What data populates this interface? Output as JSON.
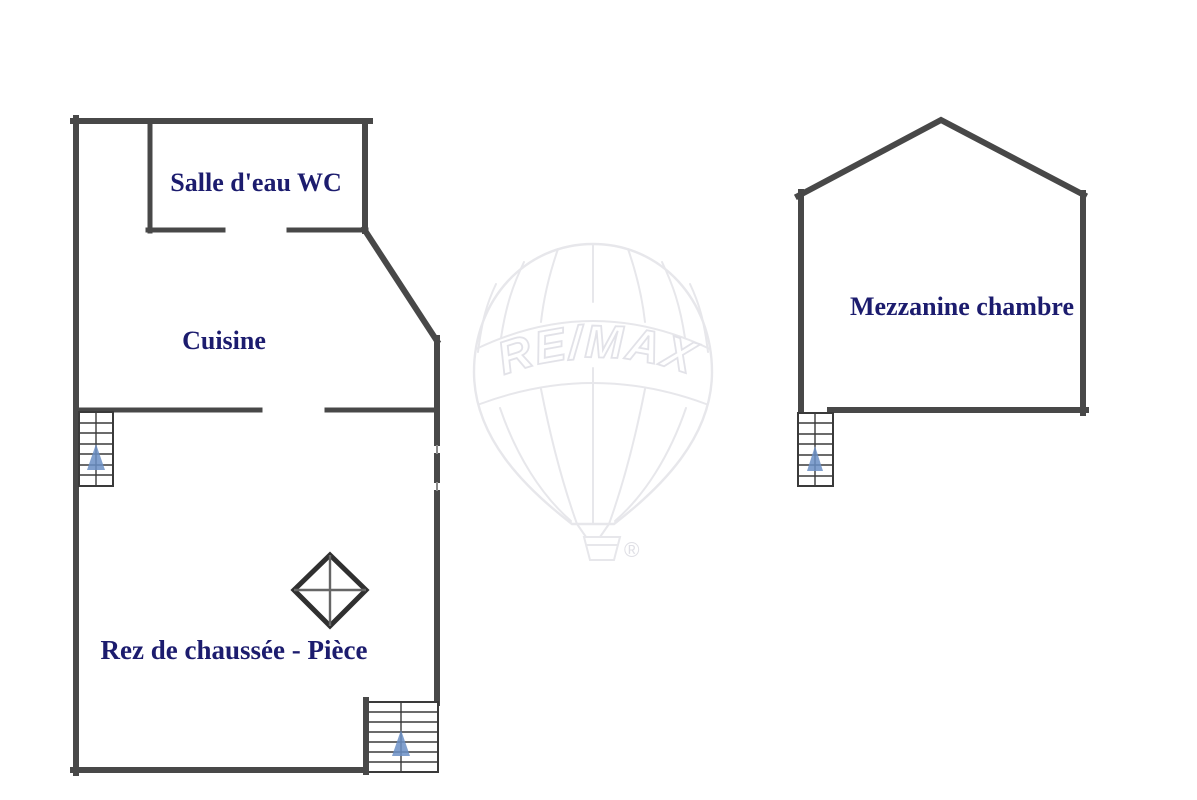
{
  "watermark": {
    "brand": "RE/MAX",
    "registered_mark": "®"
  },
  "rooms": {
    "salle_deau_wc": "Salle d'eau WC",
    "cuisine": "Cuisine",
    "rez_de_chaussee": "Rez de chaussée - Pièce",
    "mezzanine": "Mezzanine chambre"
  },
  "colors": {
    "background": "#ffffff",
    "wall": "#484848",
    "label": "#1c1c6e",
    "stair_line": "#3a3a3a",
    "stair_arrow": "#6b8fc6",
    "watermark": "#e7e7eb",
    "diamond": "#303030"
  }
}
